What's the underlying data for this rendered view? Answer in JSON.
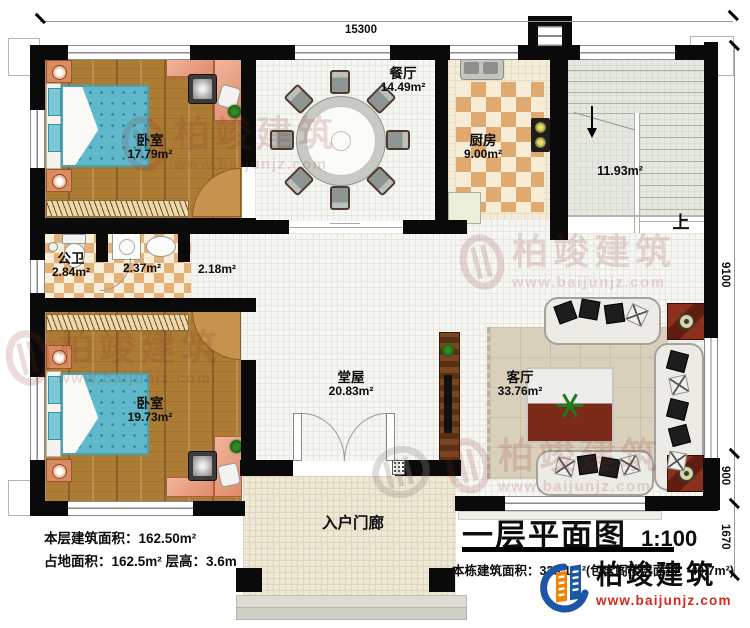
{
  "meta": {
    "title": "一层平面图",
    "scale": "1:100"
  },
  "dims": {
    "top": "15300",
    "right_top": "9100",
    "right_mid": "900",
    "right_bottom": "1670"
  },
  "rooms": {
    "bedroom1": {
      "name": "卧室",
      "area": "17.79m²"
    },
    "dining": {
      "name": "餐厅",
      "area": "14.49m²"
    },
    "kitchen": {
      "name": "厨房",
      "area": "9.00m²"
    },
    "stairs": {
      "area": "11.93m²",
      "up_label": "上"
    },
    "bath": {
      "name": "公卫",
      "area": "2.84m²"
    },
    "laundry": {
      "area": "2.37m²"
    },
    "hallway": {
      "area": "2.18m²"
    },
    "bedroom2": {
      "name": "卧室",
      "area": "19.73m²"
    },
    "hall": {
      "name": "堂屋",
      "area": "20.83m²"
    },
    "living": {
      "name": "客厅",
      "area": "33.76m²"
    },
    "porch": {
      "name": "入户门廊"
    }
  },
  "notes": {
    "floor_area": "本层建筑面积：162.50m²",
    "land_area": "占地面积：162.5m² 层高：3.6m",
    "total_area": "本栋建筑面积：325.1m²(包含阁楼层面积：40.7m²)"
  },
  "branding": {
    "watermark_text": "柏竣建筑",
    "watermark_url": "www.baijunjz.com",
    "logo_text": "柏竣建筑",
    "logo_url": "www.baijunjz.com",
    "colors": {
      "logo_blue": "#1b57a6",
      "logo_orange": "#f08300",
      "logo_red": "#d42a1e",
      "wall": "#0a0a0a",
      "wood_floor": "#ad7c34",
      "bed_blue": "#60b9cb",
      "kitchen_checker": "#dfa96f",
      "watermark_red": "#8a2a22"
    }
  }
}
